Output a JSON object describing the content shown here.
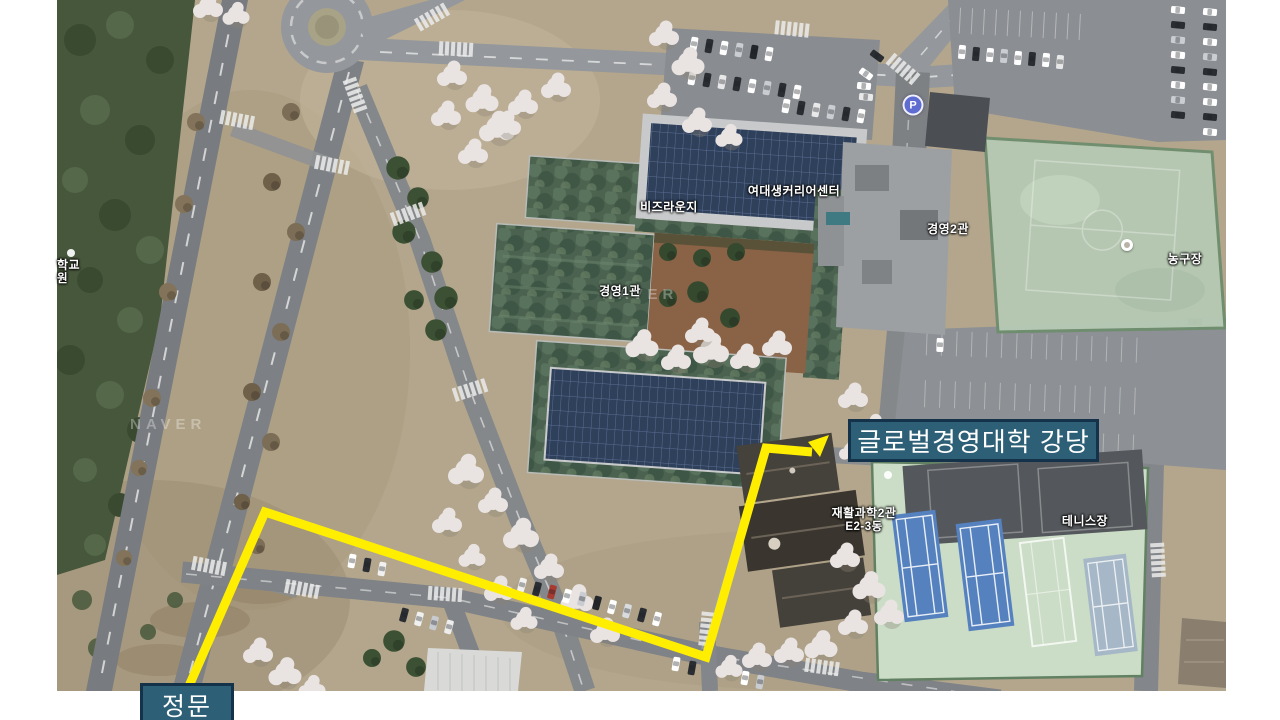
{
  "canvas": {
    "background": "#ffffff"
  },
  "map": {
    "provider_watermark": "NAVER",
    "building_labels": [
      {
        "text": "비즈라운지"
      },
      {
        "text": "여대생커리어센터"
      },
      {
        "text": "경영1관"
      },
      {
        "text": "경영2관"
      },
      {
        "text": "농구장"
      },
      {
        "text": "테니스장"
      },
      {
        "text": "재활과학2관",
        "subtext": "E2-3동"
      },
      {
        "text": "학교",
        "subtext": "원"
      }
    ],
    "markers": {
      "parking_label": "P"
    },
    "colors": {
      "terrain_tan": "#b3a68c",
      "road_gray": "#85888c",
      "forest_green": "#47573c",
      "roof_green": "#4a624f",
      "solar_panel_blue": "#2f405b",
      "tennis_court_blue": "#5581bf",
      "tennis_ground_mint": "#cbddc6",
      "basketball_court": "#b6c9b3"
    }
  },
  "route": {
    "origin_label": "정문",
    "destination_label": "글로벌경영대학 강당",
    "color": "#ffee00",
    "label_background": "#2d6076",
    "label_border": "#14334a",
    "label_text_color": "#ffffff",
    "polyline_points": "189,686 265,512 706,657 766,448 812,452",
    "arrowhead_points": "829,435 808,442 820,457"
  }
}
